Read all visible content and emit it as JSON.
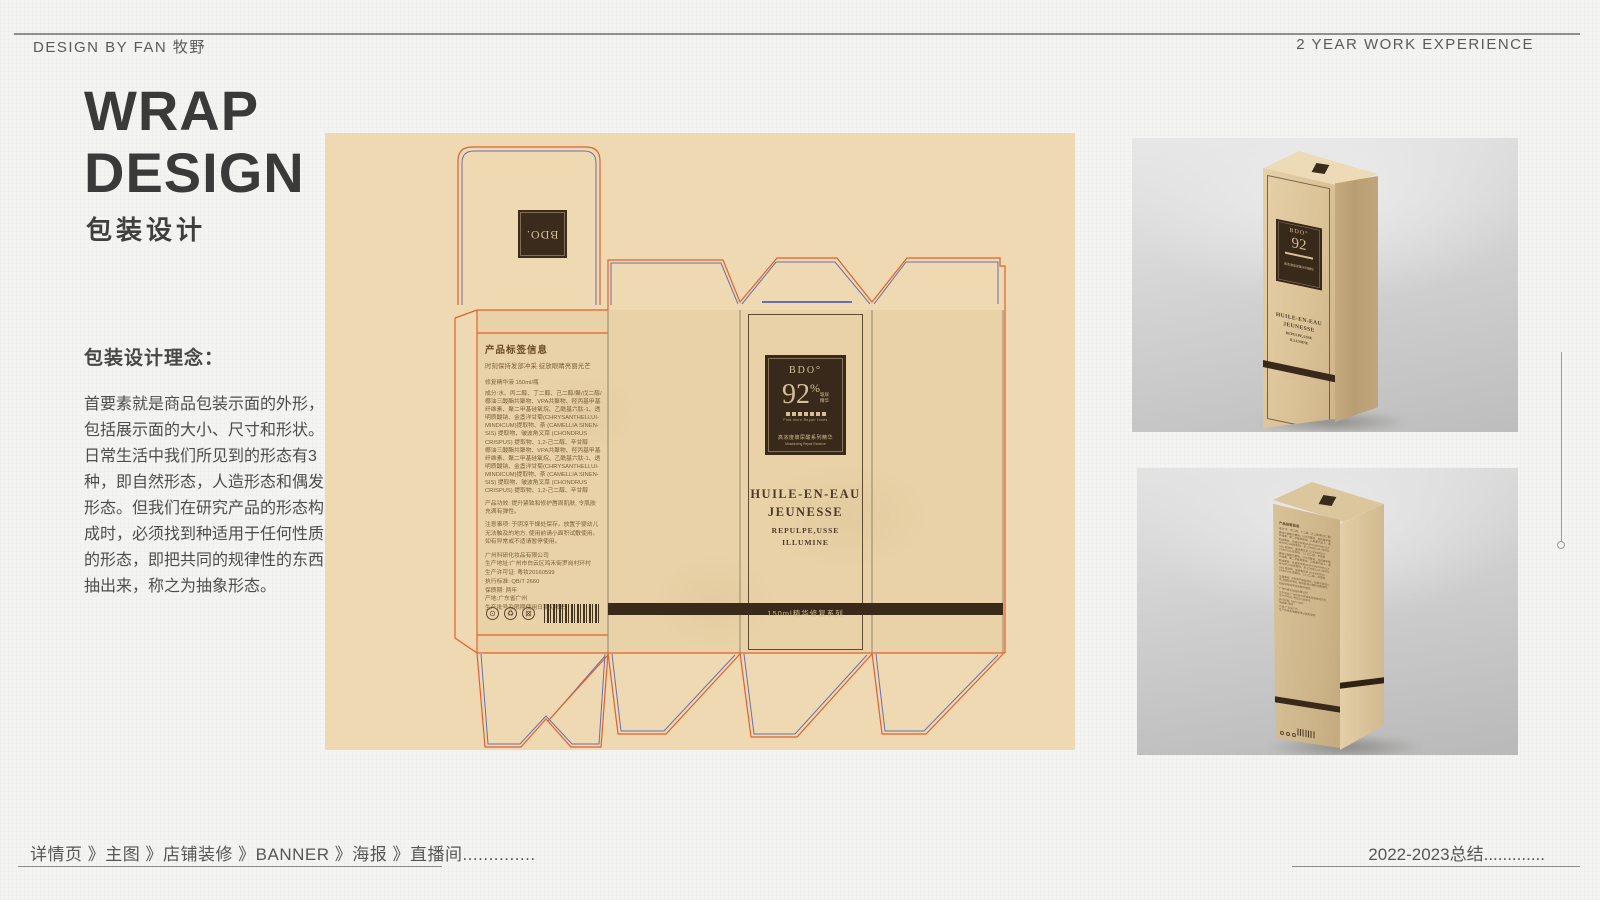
{
  "header": {
    "left": "DESIGN BY FAN 牧野",
    "right": "2 YEAR WORK EXPERIENCE"
  },
  "footer": {
    "left": "详情页 》主图 》店铺装修 》BANNER 》海报 》直播间..............",
    "right": "2022-2023总结............."
  },
  "intro": {
    "title_line1": "WRAP",
    "title_line2": "DESIGN",
    "subtitle": "包装设计",
    "concept_heading": "包装设计理念：",
    "concept_body": "首要素就是商品包装示面的外形，\n包括展示面的大小、尺寸和形状。\n日常生活中我们所见到的形态有3\n种，即自然形态，人造形态和偶发\n形态。但我们在研究产品的形态构\n成时，必须找到种适用于任何性质\n的形态，即把共同的规律性的东西\n抽出来，称之为抽象形态。"
  },
  "dieline": {
    "colors": {
      "canvas": "#eed9b2",
      "cut_line": "#e4602b",
      "fold_line": "#6770ae",
      "dark": "#39291a",
      "label_text": "#d6bf96"
    },
    "lid_brand": "BDO.",
    "back_panel": {
      "heading": "产品标签信息",
      "tagline": "时刻保持发部冲采 绽放眼睛亮丽光芒",
      "volume_line": "修复精华液 150ml/瓶",
      "ingredients": "成分:水、丙二醇、丁二醇、己二醇/聚/戊二醇/\n椰油三酸酯共聚物、VPA共聚物、羟丙基甲基\n纤维素、聚二甲基硅氧烷、乙酰基六肽-1、透\n明质酸钠、金盏洋甘菊(CHRYSANTHELLUI-\nMINDICUM)提取物、茶 (CAMELLIA SINEN-\nSIS) 提取物、皱波角叉菜 (CHONDRUS\nCRISPUS) 提取物、1,2-己二醇、辛甘醇\n椰油三酸酯共聚物、VPA共聚物、羟丙基甲基\n纤维素、聚二甲基硅氧烷、乙酰基六肽-1、透\n明质酸钠、金盏洋甘菊(CHRYSANTHELLUI-\nMINDICUM)提取物、茶 (CAMELLIA SINEN-\nSIS) 提取物、皱波角叉菜 (CHONDRUS\nCRISPUS) 提取物、1,2-己二醇、辛甘醇",
      "efficacy": "产品功效: 提升紧致和修护唇周肌肤, 令肌肤\n充满有弹性。",
      "caution": "注意事项: 于阴凉干燥处保存。放置于婴幼儿\n无法触及的地方, 使用前请小面积试敷使用。\n如有异常或不适请暂停使用。",
      "company_block": "广州科研化妆品有限公司\n生产地址:广州市白云区鸡禾街罗岗村环村\n生产许可证: 粤妆20160599\n执行标准: QB/T 2660\n保质期: 两年\n产地:广东省广州\n生产批号及限期使用日期见喷码",
      "cert_icons": [
        "⊙",
        "♻",
        "⊠"
      ]
    },
    "label": {
      "brand": "BDO°",
      "percent_number": "92",
      "percent_sign": "%",
      "percent_note": "玻尿\n精华",
      "caption_en": "Find more Repair tones",
      "bottom_zh": "高浓度玻尿酸系列精华",
      "bottom_en": "Moisturizing Repair Essence"
    },
    "front_panel": {
      "line1": "HUILE-EN-EAU",
      "line2": "JEUNESSE",
      "line3": "REPULPE,USSE",
      "line4": "ILLUMINE"
    },
    "band_text": "150ml精华修复系列"
  }
}
